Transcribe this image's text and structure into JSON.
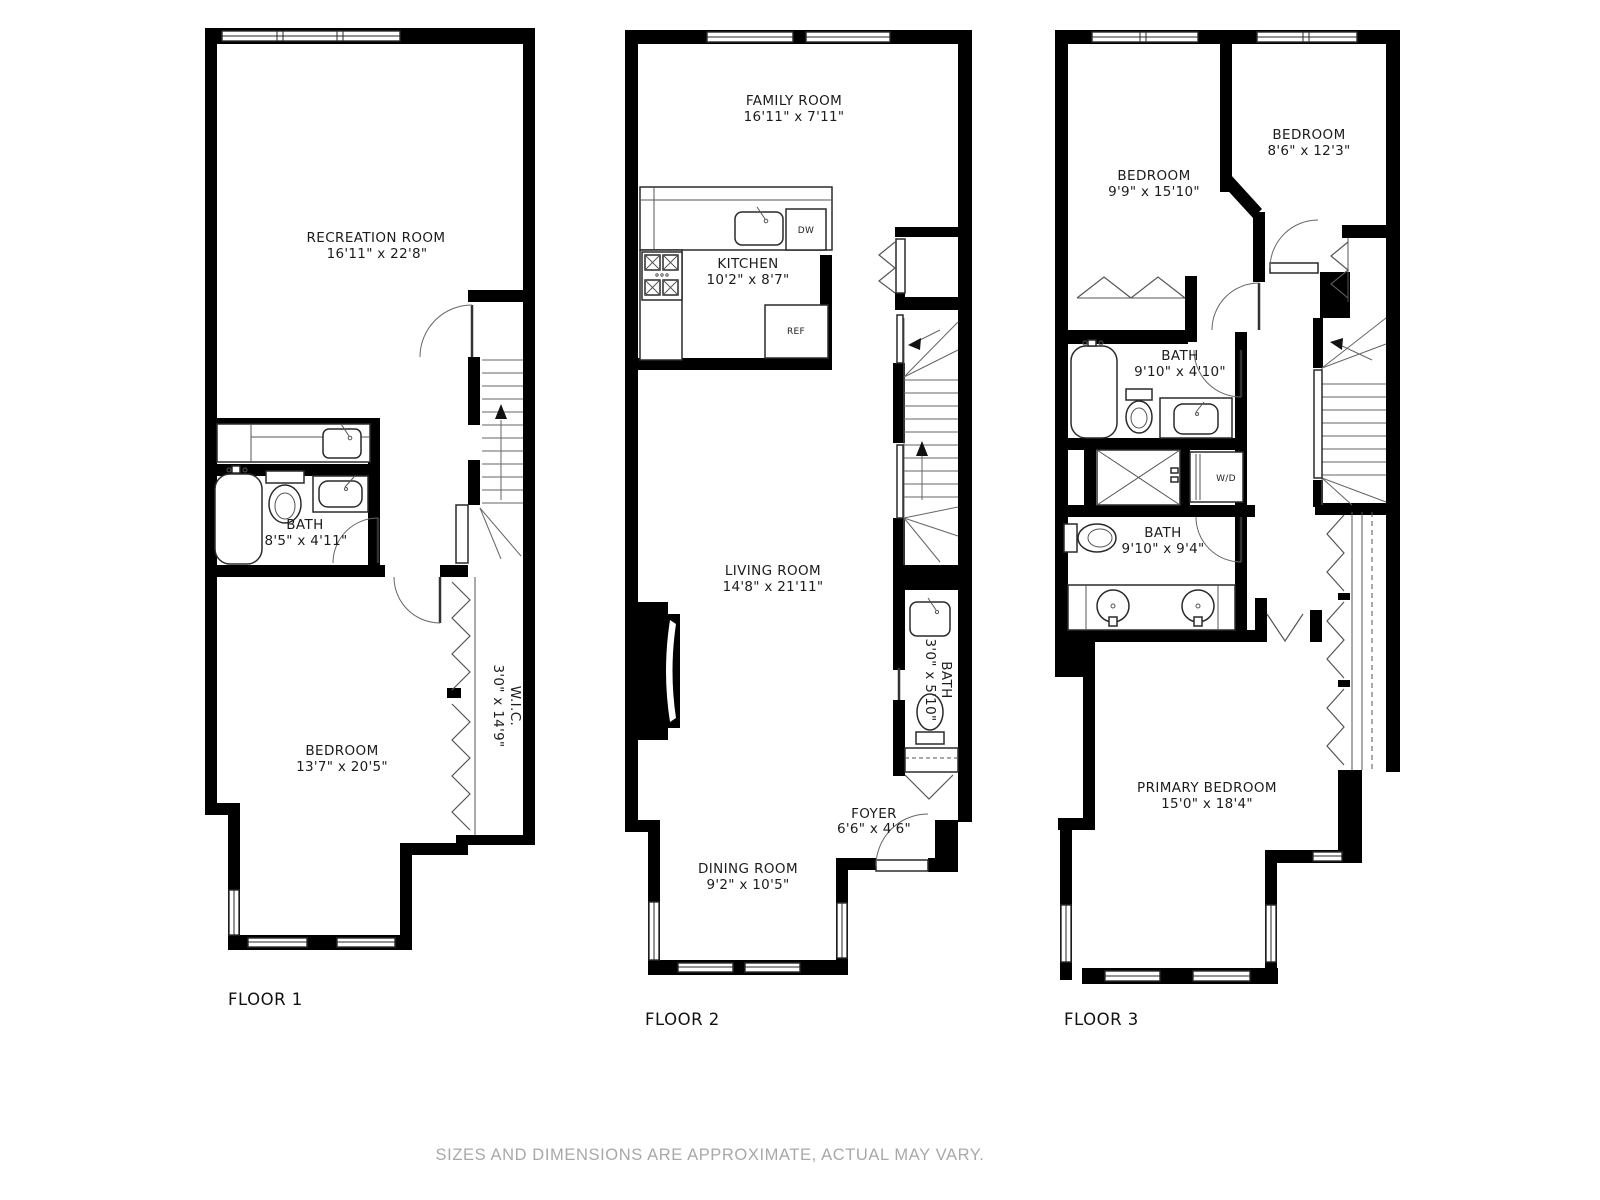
{
  "floors": [
    {
      "label": "FLOOR 1",
      "rooms": [
        {
          "name": "RECREATION ROOM",
          "dims": "16'11\" x 22'8\""
        },
        {
          "name": "BATH",
          "dims": "8'5\" x 4'11\""
        },
        {
          "name": "BEDROOM",
          "dims": "13'7\" x 20'5\""
        },
        {
          "name": "W.I.C.",
          "dims": "3'0\" x 14'9\""
        }
      ]
    },
    {
      "label": "FLOOR 2",
      "rooms": [
        {
          "name": "FAMILY ROOM",
          "dims": "16'11\" x 7'11\""
        },
        {
          "name": "KITCHEN",
          "dims": "10'2\" x 8'7\""
        },
        {
          "name": "LIVING ROOM",
          "dims": "14'8\" x 21'11\""
        },
        {
          "name": "BATH",
          "dims": "3'0\" x 5'10\""
        },
        {
          "name": "FOYER",
          "dims": "6'6\" x 4'6\""
        },
        {
          "name": "DINING ROOM",
          "dims": "9'2\" x 10'5\""
        }
      ],
      "appliances": {
        "dishwasher": "DW",
        "refrigerator": "REF"
      }
    },
    {
      "label": "FLOOR 3",
      "rooms": [
        {
          "name": "BEDROOM",
          "dims": "9'9\" x 15'10\""
        },
        {
          "name": "BEDROOM",
          "dims": "8'6\" x 12'3\""
        },
        {
          "name": "BATH",
          "dims": "9'10\" x 4'10\""
        },
        {
          "name": "BATH",
          "dims": "9'10\" x 9'4\""
        },
        {
          "name": "PRIMARY BEDROOM",
          "dims": "15'0\" x 18'4\""
        }
      ],
      "appliances": {
        "washer_dryer": "W/D"
      }
    }
  ],
  "disclaimer": "SIZES AND DIMENSIONS ARE APPROXIMATE, ACTUAL MAY VARY.",
  "colors": {
    "wall": "#000000",
    "background": "#ffffff",
    "disclaimer_text": "#a8a8a8"
  }
}
